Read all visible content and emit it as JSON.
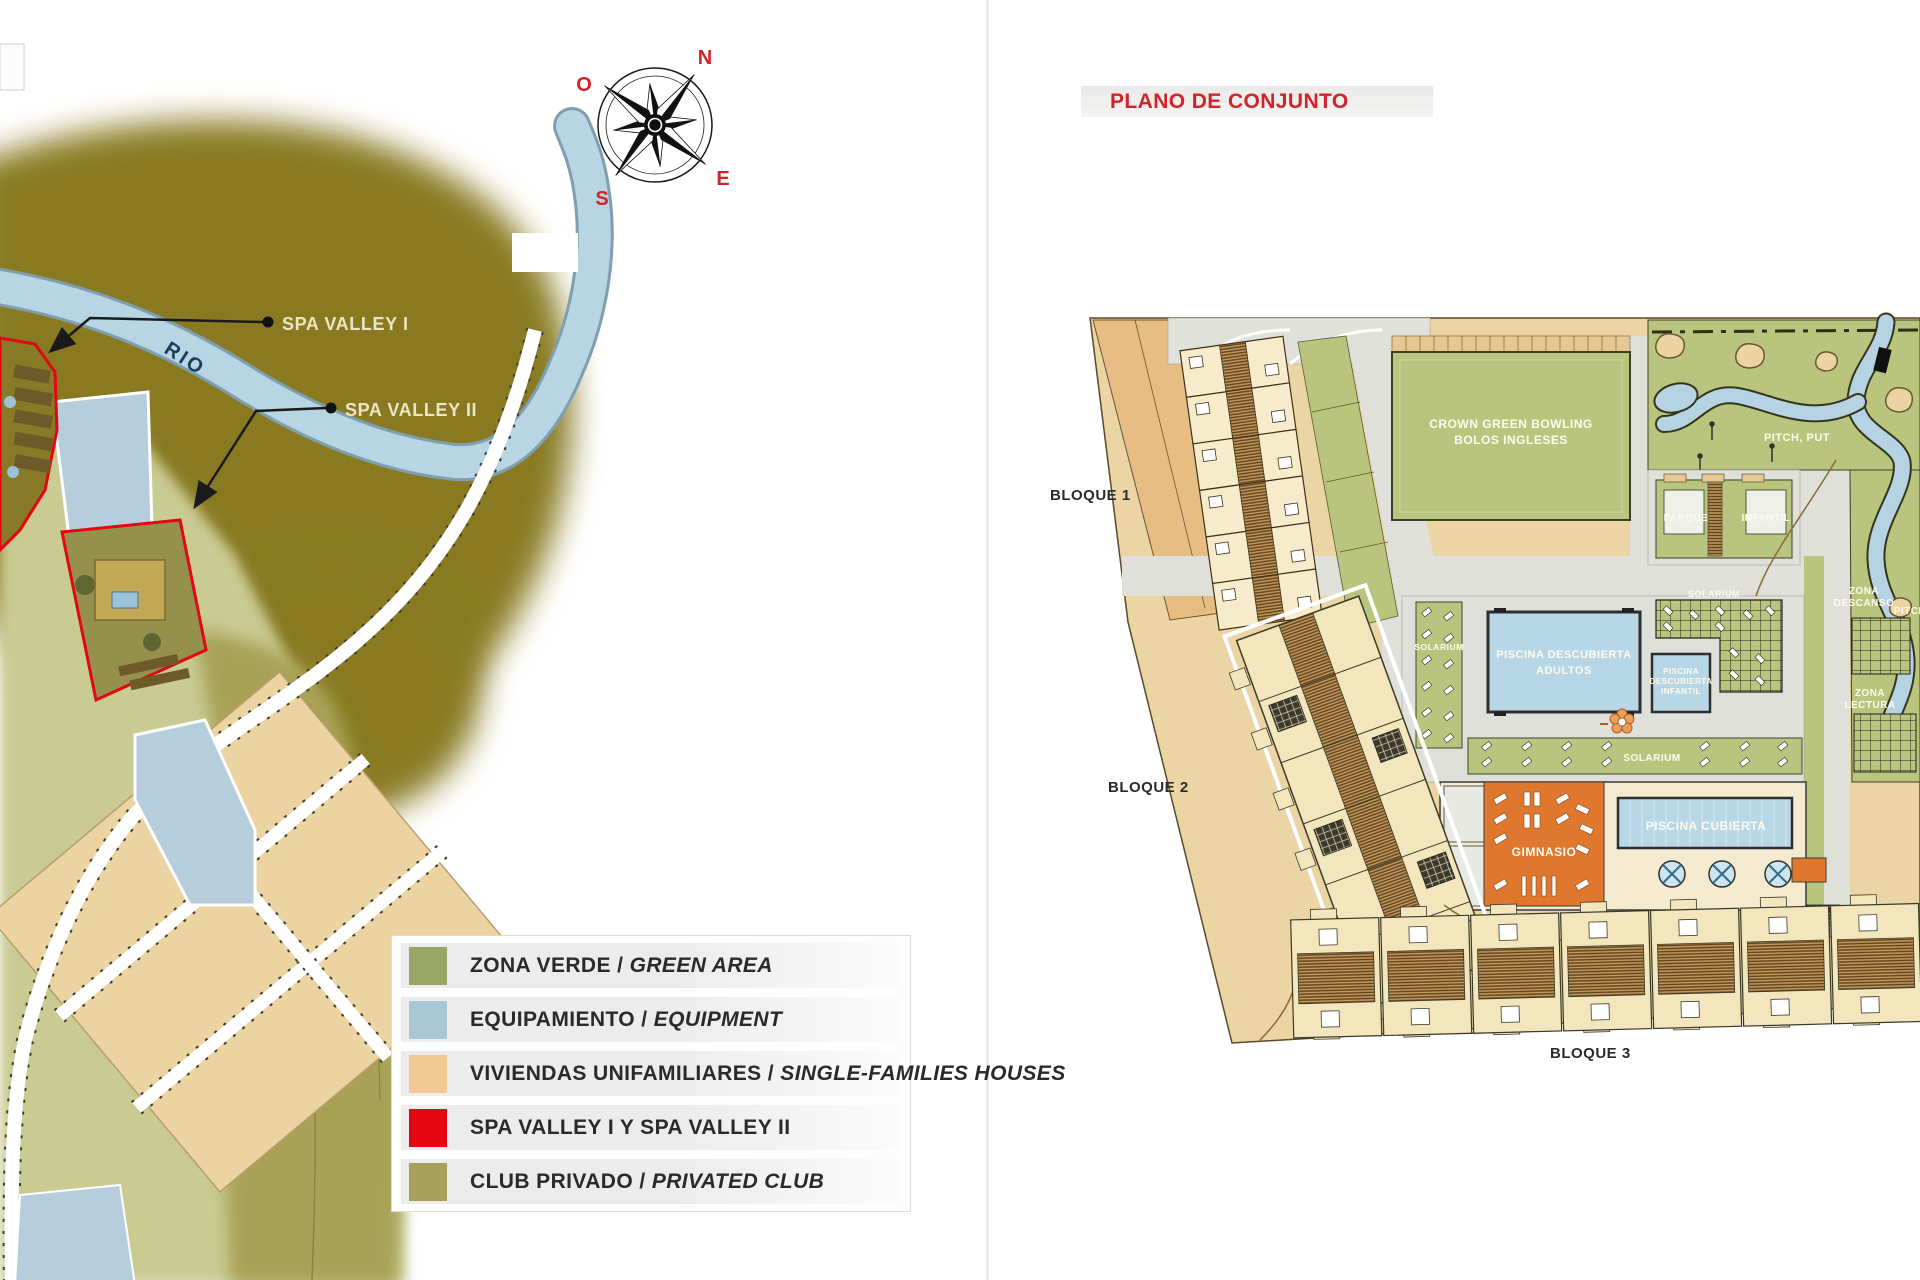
{
  "left_panel": {
    "compass": {
      "n": "N",
      "o": "O",
      "e": "E",
      "s": "S"
    },
    "river_label": "RIO",
    "callouts": {
      "spa1": "SPA VALLEY I",
      "spa2": "SPA VALLEY II"
    },
    "legend": {
      "items": [
        {
          "es": "ZONA VERDE",
          "sep": " / ",
          "en": "GREEN AREA",
          "color": "#9BA769"
        },
        {
          "es": "EQUIPAMIENTO",
          "sep": " / ",
          "en": "EQUIPMENT",
          "color": "#A9C6D2"
        },
        {
          "es": "VIVIENDAS UNIFAMILIARES",
          "sep": " / ",
          "en": "SINGLE-FAMILIES HOUSES",
          "color": "#EFC893"
        },
        {
          "es": "SPA VALLEY I Y SPA VALLEY II",
          "sep": "",
          "en": "",
          "color": "#E30613"
        },
        {
          "es": "CLUB PRIVADO",
          "sep": " / ",
          "en": "PRIVATED CLUB",
          "color": "#A8A15B"
        }
      ]
    }
  },
  "right_panel": {
    "title": "PLANO DE CONJUNTO",
    "labels": {
      "bloque_1": "BLOQUE 1",
      "bloque_2": "BLOQUE 2",
      "bloque_3": "BLOQUE 3",
      "bowling_1": "CROWN GREEN BOWLING",
      "bowling_2": "BOLOS INGLESES",
      "pitch_put": "PITCH, PUT",
      "pitch_side": "PITCH",
      "parque_1": "PARQUE",
      "parque_2": "INFANTIL",
      "solarium_left": "SOLARIUM",
      "solarium_top": "SOLARIUM",
      "solarium_bottom": "SOLARIUM",
      "adultos_1": "PISCINA DESCUBIERTA",
      "adultos_2": "ADULTOS",
      "infantil_1": "PISCINA",
      "infantil_2": "DESCUBIERTA",
      "infantil_3": "INFANTIL",
      "gimnasio": "GIMNASIO",
      "piscina_cubierta": "PISCINA CUBIERTA",
      "descanso_1": "ZONA",
      "descanso_2": "DESCANSO",
      "lectura_1": "ZONA",
      "lectura_2": "LECTURA"
    }
  },
  "colors": {
    "accent_red": "#D2232A",
    "spa_red": "#E30613",
    "river_blue": "#B7D5E3",
    "plan_green": "#B9C57E",
    "plan_tan": "#EBD5A4",
    "gym_orange": "#E0772F",
    "pool_blue": "#B8D7E6",
    "olive_terrain": "#897A20"
  }
}
